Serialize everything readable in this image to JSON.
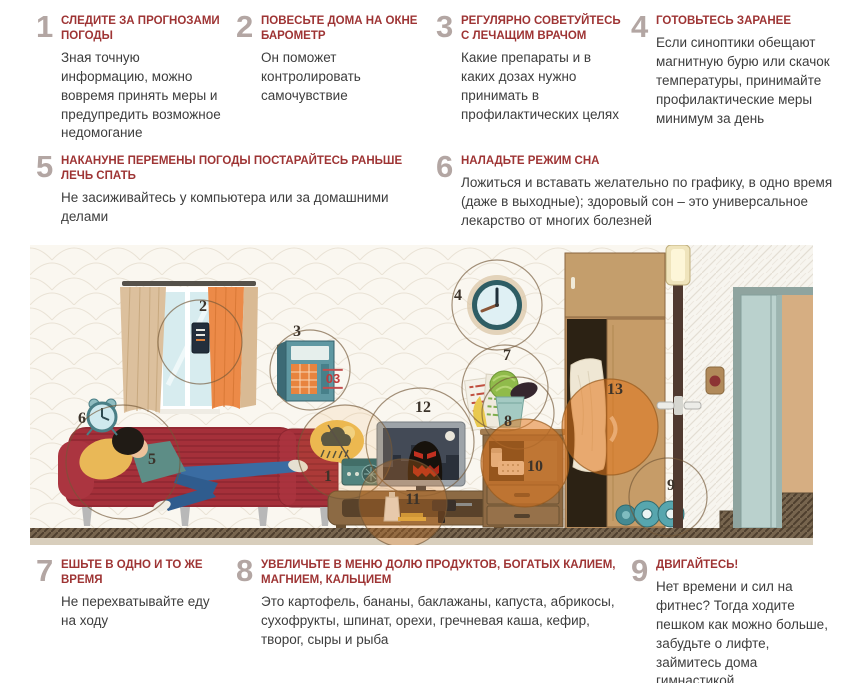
{
  "colors": {
    "accent_red": "#9e3434",
    "number_gray": "#b3a6a3",
    "body_text": "#3d3d3d",
    "highlight_orange": "#e27a1e",
    "sofa_red": "#a5303a"
  },
  "tips": [
    {
      "num": "1",
      "title": "СЛЕДИТЕ ЗА ПРОГНОЗАМИ ПОГОДЫ",
      "body": "Зная точную информацию, можно вовремя принять меры и предупредить возможное недомогание"
    },
    {
      "num": "2",
      "title": "ПОВЕСЬТЕ ДОМА НА ОКНЕ БАРОМЕТР",
      "body": "Он поможет контролировать самочувствие"
    },
    {
      "num": "3",
      "title": "РЕГУЛЯРНО СОВЕТУЙТЕСЬ С ЛЕЧАЩИМ ВРАЧОМ",
      "body": "Какие препараты и в каких дозах нужно принимать в профилактических целях"
    },
    {
      "num": "4",
      "title": "ГОТОВЬТЕСЬ ЗАРАНЕЕ",
      "body": "Если синоптики обещают магнитную бурю или скачок температуры, принимайте профилактические меры минимум за день"
    },
    {
      "num": "5",
      "title": "НАКАНУНЕ ПЕРЕМЕНЫ ПОГОДЫ ПОСТАРАЙТЕСЬ РАНЬШЕ ЛЕЧЬ СПАТЬ",
      "body": "Не засиживайтесь у компьютера или за домашними делами"
    },
    {
      "num": "6",
      "title": "НАЛАДЬТЕ РЕЖИМ СНА",
      "body": "Ложиться и вставать желательно по графику, в одно время (даже в выходные); здоровый сон – это универсальное лекарство от многих болезней"
    },
    {
      "num": "7",
      "title": "ЕШЬТЕ В ОДНО И ТО ЖЕ ВРЕМЯ",
      "body": "Не перехватывайте еду на ходу"
    },
    {
      "num": "8",
      "title": "УВЕЛИЧЬТЕ В МЕНЮ ДОЛЮ ПРОДУКТОВ, БОГАТЫХ КАЛИЕМ, МАГНИЕМ, КАЛЬЦИЕМ",
      "body": "Это картофель, бананы, баклажаны, капуста, абрикосы, сухофрукты, шпинат, орехи, гречневая каша, кефир, творог, сыры и рыба"
    },
    {
      "num": "9",
      "title": "ДВИГАЙТЕСЬ!",
      "body": "Нет времени и сил на фитнес? Тогда ходите пешком как можно больше, забудьте о лифте, займитесь дома гимнастикой"
    }
  ],
  "illustration": {
    "phone_label": "03",
    "markers": [
      {
        "label": "1"
      },
      {
        "label": "2"
      },
      {
        "label": "3"
      },
      {
        "label": "4"
      },
      {
        "label": "5"
      },
      {
        "label": "6"
      },
      {
        "label": "7"
      },
      {
        "label": "8"
      },
      {
        "label": "9"
      },
      {
        "label": "10"
      },
      {
        "label": "11"
      },
      {
        "label": "12"
      },
      {
        "label": "13"
      }
    ]
  }
}
